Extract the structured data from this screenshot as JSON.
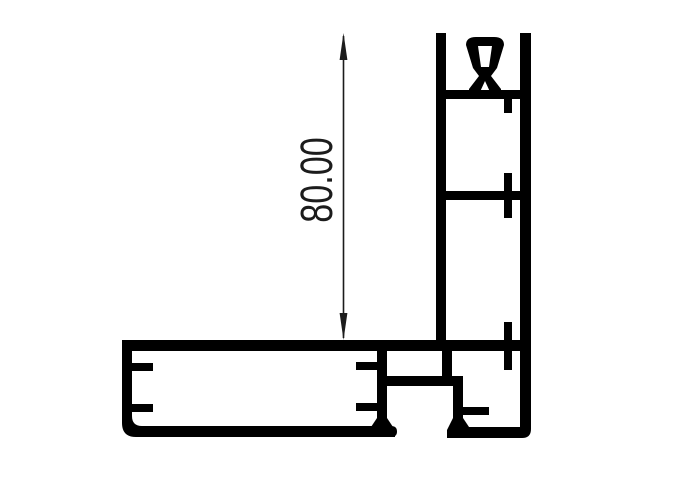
{
  "colors": {
    "background": "#ffffff",
    "line": "#000000",
    "dimension": "#1c1c1c"
  },
  "dimension": {
    "value": "80.00"
  }
}
